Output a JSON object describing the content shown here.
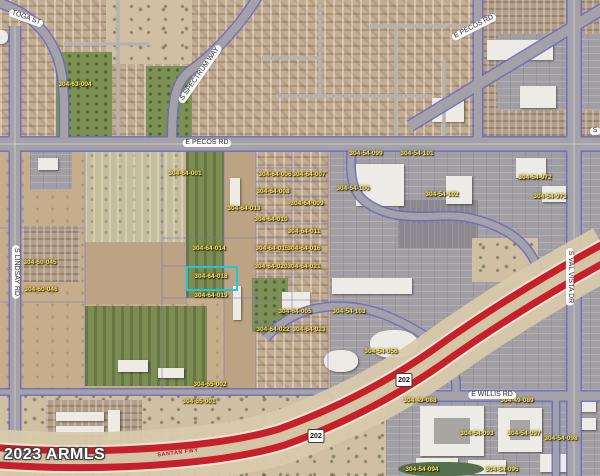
{
  "map": {
    "watermark": "2023 ARMLS",
    "colors": {
      "highlight": "#1fc8d2",
      "freeway_red": "#c8202a",
      "apn_yellow": "#ffe359"
    },
    "freeway_label": {
      "text": "SANTAN FWY"
    },
    "route_shields": [
      {
        "text": "202",
        "x": 404,
        "y": 380
      },
      {
        "text": "202",
        "x": 316,
        "y": 436
      }
    ],
    "road_labels": [
      {
        "text": "TOGA ST",
        "x": 26,
        "y": 18,
        "rotate": 20
      },
      {
        "text": "S SPECTRUM WAY",
        "x": 200,
        "y": 74,
        "rotate": -55
      },
      {
        "text": "E PECOS RD",
        "x": 207,
        "y": 143,
        "rotate": 0
      },
      {
        "text": "E PECOS RD",
        "x": 474,
        "y": 27,
        "rotate": -27
      },
      {
        "text": "S LINDSAY RD",
        "x": 16,
        "y": 272,
        "rotate": 90
      },
      {
        "text": "S VAL VISTA DR",
        "x": 570,
        "y": 277,
        "rotate": 90
      },
      {
        "text": "E WILLIS RD",
        "x": 492,
        "y": 395,
        "rotate": 0
      },
      {
        "text": "S",
        "x": 595,
        "y": 131,
        "rotate": 0
      }
    ],
    "apn_labels": [
      {
        "text": "304-63-004",
        "x": 75,
        "y": 85
      },
      {
        "text": "304-60-045",
        "x": 40,
        "y": 263
      },
      {
        "text": "304-60-046",
        "x": 41,
        "y": 290
      },
      {
        "text": "304-64-001",
        "x": 185,
        "y": 174
      },
      {
        "text": "304-64-006",
        "x": 275,
        "y": 175
      },
      {
        "text": "304-64-007",
        "x": 309,
        "y": 175
      },
      {
        "text": "304-64-008",
        "x": 273,
        "y": 192
      },
      {
        "text": "304-64-009",
        "x": 307,
        "y": 204
      },
      {
        "text": "304-64-013",
        "x": 244,
        "y": 209
      },
      {
        "text": "304-64-010",
        "x": 271,
        "y": 220
      },
      {
        "text": "304-64-011",
        "x": 304,
        "y": 232
      },
      {
        "text": "304-64-014",
        "x": 209,
        "y": 249
      },
      {
        "text": "304-64-015",
        "x": 272,
        "y": 249
      },
      {
        "text": "304-64-016",
        "x": 304,
        "y": 249
      },
      {
        "text": "304-64-018",
        "x": 211,
        "y": 277
      },
      {
        "text": "304-64-019",
        "x": 211,
        "y": 296
      },
      {
        "text": "304-64-020",
        "x": 271,
        "y": 267
      },
      {
        "text": "304-64-021",
        "x": 304,
        "y": 267
      },
      {
        "text": "304-64-022",
        "x": 273,
        "y": 330
      },
      {
        "text": "304-64-023",
        "x": 309,
        "y": 330
      },
      {
        "text": "304-64-005",
        "x": 295,
        "y": 312
      },
      {
        "text": "304-65-002",
        "x": 210,
        "y": 385
      },
      {
        "text": "304-65-001",
        "x": 199,
        "y": 402
      },
      {
        "text": "304-54-099",
        "x": 366,
        "y": 154
      },
      {
        "text": "304-54-101",
        "x": 417,
        "y": 154
      },
      {
        "text": "304-54-100",
        "x": 353,
        "y": 189
      },
      {
        "text": "304-54-102",
        "x": 442,
        "y": 195
      },
      {
        "text": "304-54-103",
        "x": 349,
        "y": 312
      },
      {
        "text": "304-54-056",
        "x": 381,
        "y": 352
      },
      {
        "text": "304-54-972",
        "x": 535,
        "y": 178
      },
      {
        "text": "304-54-973",
        "x": 550,
        "y": 197
      },
      {
        "text": "304-49-088",
        "x": 420,
        "y": 401
      },
      {
        "text": "304-49-089",
        "x": 517,
        "y": 401
      },
      {
        "text": "304-54-093",
        "x": 477,
        "y": 434
      },
      {
        "text": "304-54-097",
        "x": 524,
        "y": 434
      },
      {
        "text": "304-54-098",
        "x": 561,
        "y": 439
      },
      {
        "text": "304-54-094",
        "x": 422,
        "y": 470
      },
      {
        "text": "304-54-095",
        "x": 502,
        "y": 470
      }
    ]
  }
}
